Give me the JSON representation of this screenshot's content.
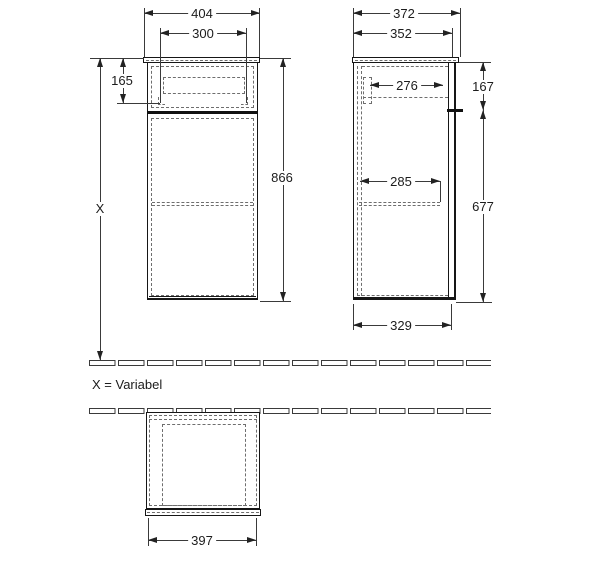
{
  "drawing": {
    "note": "X = Variabel",
    "front_view": {
      "width_top": "404",
      "width_inner": "300",
      "drawer_height": "165",
      "total_height": "866",
      "height_variable": "X"
    },
    "side_view": {
      "depth_top": "372",
      "depth_inner": "352",
      "drawer_depth": "276",
      "drawer_section_height": "167",
      "shelf_depth": "285",
      "body_height": "677",
      "base_depth": "329"
    },
    "plan_view": {
      "width": "397"
    },
    "colors": {
      "object_line": "#161616",
      "dashed_line": "#6e6e6e",
      "dimension_line": "#3a3a3a",
      "text": "#1c1c1c",
      "background": "#ffffff"
    }
  }
}
